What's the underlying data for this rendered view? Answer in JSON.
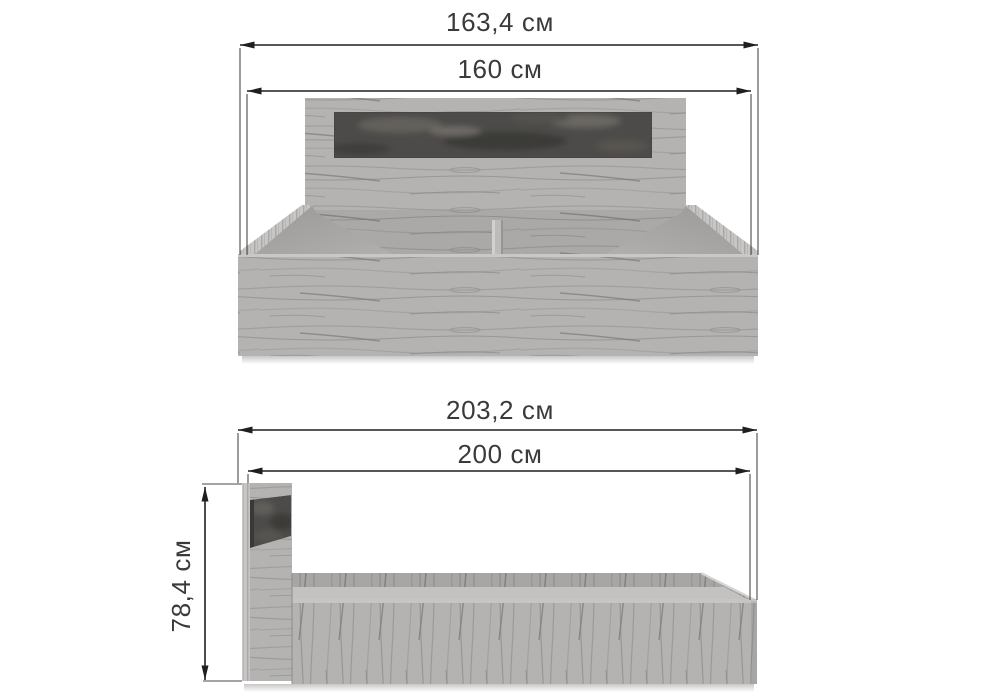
{
  "figures": {
    "front_view": {
      "outer_width": "163,4 см",
      "inner_width": "160 см"
    },
    "side_view": {
      "outer_length": "203,2 см",
      "inner_length": "200 см",
      "height": "78,4 см"
    }
  },
  "colors": {
    "background": "#ffffff",
    "wood_light": "#b4b3b2",
    "wood_grain": "#8f8e8d",
    "wood_edge": "#c7c6c5",
    "insert_dark": "#4d4b49",
    "dimension_line": "#1f1f1f",
    "extension_line": "#4a4a4a",
    "label_text": "#3a3a3a"
  }
}
